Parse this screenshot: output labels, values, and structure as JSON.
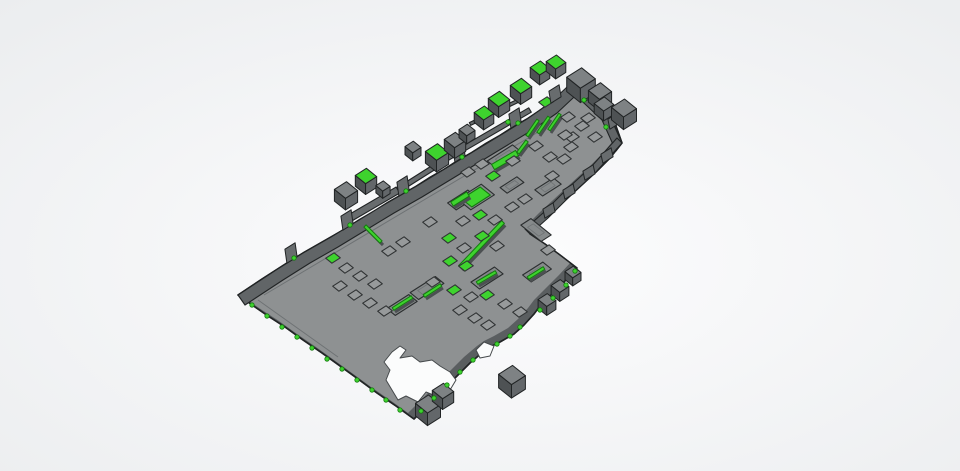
{
  "scene": {
    "canvas": {
      "width": 960,
      "height": 471
    },
    "colors": {
      "bg_center": "#fdfdfe",
      "bg_edge": "#eaecee",
      "plate": "#8e9192",
      "plate_wall": "#5a5e60",
      "outline": "#212425",
      "band": "#616567",
      "arm": "#686c6e",
      "trench_fill": "#868a8b",
      "trench_stroke": "#2b2e2f",
      "bump_fill": "#979a9b",
      "bump_stroke": "#303334",
      "green": "#3ed32e",
      "green_stroke": "#157a10",
      "strip_shadow": "#4c5052",
      "cube_top": "#7e8284",
      "cube_left": "#4e5254",
      "cube_right": "#63676a",
      "hole_fill": "#fbfcfc",
      "hole_stroke": "#45494b",
      "inner_line": "#6e7274"
    },
    "axes": {
      "u": [
        0.843,
        -0.538
      ],
      "v": [
        0.78,
        0.625
      ]
    },
    "plate_outline": [
      [
        573,
        80
      ],
      [
        583,
        89
      ],
      [
        591,
        96
      ],
      [
        600,
        104
      ],
      [
        608,
        112
      ],
      [
        616,
        126
      ],
      [
        622,
        143
      ],
      [
        610,
        158
      ],
      [
        596,
        172
      ],
      [
        585,
        182
      ],
      [
        572,
        194
      ],
      [
        558,
        207
      ],
      [
        545,
        219
      ],
      [
        530,
        234
      ],
      [
        545,
        244
      ],
      [
        560,
        255
      ],
      [
        577,
        268
      ],
      [
        565,
        281
      ],
      [
        552,
        294
      ],
      [
        540,
        306
      ],
      [
        534,
        314
      ],
      [
        524,
        325
      ],
      [
        514,
        334
      ],
      [
        500,
        342
      ],
      [
        490,
        347
      ],
      [
        483,
        352
      ],
      [
        470,
        363
      ],
      [
        458,
        375
      ],
      [
        446,
        387
      ],
      [
        434,
        399
      ],
      [
        424,
        409
      ],
      [
        414,
        419
      ],
      [
        396,
        406
      ],
      [
        377,
        393
      ],
      [
        358,
        379
      ],
      [
        340,
        366
      ],
      [
        322,
        353
      ],
      [
        303,
        340
      ],
      [
        285,
        327
      ],
      [
        268,
        316
      ],
      [
        255,
        307
      ],
      [
        238,
        295
      ],
      [
        250,
        287
      ],
      [
        262,
        279
      ],
      [
        276,
        270
      ],
      [
        290,
        261
      ],
      [
        303,
        253
      ],
      [
        317,
        245
      ],
      [
        331,
        237
      ],
      [
        345,
        229
      ],
      [
        359,
        220
      ],
      [
        373,
        212
      ],
      [
        387,
        203
      ],
      [
        401,
        195
      ],
      [
        415,
        187
      ],
      [
        429,
        178
      ],
      [
        443,
        170
      ],
      [
        457,
        161
      ],
      [
        471,
        153
      ],
      [
        485,
        144
      ],
      [
        499,
        136
      ],
      [
        513,
        127
      ],
      [
        527,
        119
      ],
      [
        539,
        111
      ],
      [
        550,
        103
      ],
      [
        560,
        96
      ],
      [
        567,
        88
      ]
    ],
    "inner_shift": [
      -6,
      -6
    ],
    "bands": [
      {
        "edge": [
          [
            238,
            295
          ],
          [
            276,
            270
          ],
          [
            303,
            253
          ],
          [
            331,
            237
          ],
          [
            359,
            220
          ],
          [
            387,
            203
          ],
          [
            415,
            187
          ],
          [
            443,
            170
          ],
          [
            471,
            153
          ],
          [
            499,
            136
          ],
          [
            527,
            119
          ],
          [
            550,
            103
          ],
          [
            566,
            88
          ],
          [
            573,
            80
          ]
        ],
        "off": [
          7,
          10
        ]
      },
      {
        "edge": [
          [
            573,
            80
          ],
          [
            591,
            96
          ],
          [
            608,
            112
          ],
          [
            622,
            143
          ]
        ],
        "off": [
          -6,
          8
        ]
      },
      {
        "edge": [
          [
            622,
            143
          ],
          [
            596,
            172
          ],
          [
            572,
            194
          ],
          [
            548,
            218
          ],
          [
            530,
            234
          ]
        ],
        "off": [
          -5,
          -5
        ]
      }
    ],
    "teeth": [
      {
        "x": 292,
        "y": 260,
        "h": 14
      },
      {
        "x": 348,
        "y": 227,
        "h": 14
      },
      {
        "x": 404,
        "y": 193,
        "h": 14
      },
      {
        "x": 460,
        "y": 159,
        "h": 14
      },
      {
        "x": 516,
        "y": 125,
        "h": 14
      },
      {
        "x": 556,
        "y": 100,
        "h": 12
      },
      {
        "x": 589,
        "y": 99,
        "h": 10
      },
      {
        "x": 603,
        "y": 112,
        "h": 10
      },
      {
        "x": 615,
        "y": 126,
        "h": 10
      },
      {
        "x": 608,
        "y": 160,
        "h": 9
      },
      {
        "x": 590,
        "y": 177,
        "h": 9
      },
      {
        "x": 570,
        "y": 196,
        "h": 9
      },
      {
        "x": 550,
        "y": 215,
        "h": 9
      }
    ],
    "arm_strips": [
      {
        "p": [
          350,
          218,
          398,
          190
        ],
        "w": 7
      },
      {
        "p": [
          398,
          190,
          436,
          166
        ],
        "w": 5
      },
      {
        "p": [
          444,
          160,
          530,
          110
        ],
        "w": 5
      },
      {
        "p": [
          470,
          124,
          528,
          96
        ],
        "w": 3
      }
    ],
    "inner_lines": [
      [
        264,
        295,
        545,
        128
      ],
      [
        258,
        300,
        338,
        357
      ]
    ],
    "trenches": [
      [
        505,
        157,
        30,
        13
      ],
      [
        462,
        200,
        24,
        11
      ],
      [
        427,
        288,
        30,
        11
      ],
      [
        402,
        305,
        26,
        11
      ],
      [
        487,
        278,
        28,
        11
      ],
      [
        537,
        272,
        24,
        11
      ],
      [
        512,
        185,
        20,
        9
      ],
      [
        548,
        187,
        22,
        10
      ],
      [
        536,
        230,
        12,
        26
      ],
      [
        476,
        197,
        28,
        17
      ]
    ],
    "pads": [
      [
        476,
        197,
        22,
        13
      ]
    ],
    "strips": [
      [
        503,
        222,
        460,
        267,
        4
      ],
      [
        538,
        120,
        527,
        136,
        3
      ],
      [
        549,
        117,
        538,
        133,
        3
      ],
      [
        560,
        114,
        549,
        130,
        3
      ],
      [
        527,
        141,
        518,
        153,
        3
      ],
      [
        365,
        226,
        381,
        242,
        3
      ],
      [
        493,
        167,
        517,
        153,
        6
      ],
      [
        452,
        204,
        468,
        194,
        5
      ],
      [
        393,
        309,
        412,
        297,
        3
      ],
      [
        424,
        296,
        441,
        285,
        3
      ],
      [
        477,
        283,
        496,
        272,
        3
      ],
      [
        528,
        278,
        544,
        268,
        3
      ]
    ],
    "bumps": [
      [
        468,
        172,
        0
      ],
      [
        482,
        164,
        0
      ],
      [
        493,
        176,
        1
      ],
      [
        513,
        161,
        0
      ],
      [
        536,
        146,
        0
      ],
      [
        550,
        157,
        0
      ],
      [
        572,
        137,
        0
      ],
      [
        546,
        102,
        1
      ],
      [
        568,
        117,
        0
      ],
      [
        582,
        126,
        0
      ],
      [
        565,
        135,
        0
      ],
      [
        571,
        147,
        0
      ],
      [
        564,
        159,
        0
      ],
      [
        588,
        118,
        0
      ],
      [
        595,
        137,
        0
      ],
      [
        449,
        238,
        1
      ],
      [
        464,
        248,
        0
      ],
      [
        482,
        236,
        1
      ],
      [
        497,
        246,
        0
      ],
      [
        450,
        261,
        1
      ],
      [
        466,
        266,
        1
      ],
      [
        433,
        282,
        0
      ],
      [
        454,
        290,
        1
      ],
      [
        471,
        297,
        0
      ],
      [
        487,
        295,
        1
      ],
      [
        505,
        304,
        0
      ],
      [
        520,
        312,
        0
      ],
      [
        333,
        258,
        1
      ],
      [
        346,
        268,
        0
      ],
      [
        360,
        276,
        0
      ],
      [
        375,
        284,
        0
      ],
      [
        340,
        286,
        0
      ],
      [
        355,
        295,
        0
      ],
      [
        370,
        303,
        0
      ],
      [
        385,
        311,
        0
      ],
      [
        475,
        318,
        0
      ],
      [
        488,
        325,
        0
      ],
      [
        460,
        310,
        0
      ],
      [
        525,
        199,
        0
      ],
      [
        512,
        207,
        0
      ],
      [
        552,
        176,
        0
      ],
      [
        495,
        220,
        0
      ],
      [
        548,
        250,
        0
      ],
      [
        430,
        222,
        0
      ],
      [
        480,
        215,
        1
      ],
      [
        463,
        221,
        0
      ],
      [
        403,
        242,
        0
      ],
      [
        389,
        251,
        0
      ]
    ],
    "cubes": [
      [
        346,
        190,
        13,
        0
      ],
      [
        366,
        176,
        12,
        1
      ],
      [
        383,
        186,
        8,
        0
      ],
      [
        413,
        147,
        9,
        0
      ],
      [
        437,
        152,
        13,
        1
      ],
      [
        455,
        140,
        12,
        0
      ],
      [
        467,
        130,
        9,
        0
      ],
      [
        484,
        113,
        11,
        1
      ],
      [
        499,
        99,
        12,
        1
      ],
      [
        521,
        86,
        12,
        1
      ],
      [
        540,
        68,
        11,
        1
      ],
      [
        556,
        62,
        11,
        1
      ],
      [
        581,
        78,
        16,
        0
      ],
      [
        600,
        91,
        13,
        0
      ],
      [
        604,
        104,
        11,
        0
      ],
      [
        624,
        108,
        14,
        0
      ],
      [
        512,
        375,
        15,
        0
      ],
      [
        428,
        404,
        14,
        0
      ],
      [
        443,
        391,
        12,
        0
      ],
      [
        573,
        272,
        9,
        0
      ],
      [
        560,
        286,
        10,
        0
      ],
      [
        547,
        300,
        10,
        0
      ]
    ],
    "studs": [
      [
        252,
        305
      ],
      [
        267,
        316
      ],
      [
        282,
        327
      ],
      [
        297,
        337
      ],
      [
        312,
        348
      ],
      [
        327,
        359
      ],
      [
        342,
        369
      ],
      [
        357,
        380
      ],
      [
        372,
        390
      ],
      [
        386,
        400
      ],
      [
        400,
        410
      ],
      [
        421,
        411
      ],
      [
        434,
        398
      ],
      [
        447,
        385
      ],
      [
        460,
        372
      ],
      [
        473,
        360
      ],
      [
        497,
        344
      ],
      [
        510,
        336
      ],
      [
        520,
        327
      ],
      [
        540,
        310
      ],
      [
        553,
        298
      ],
      [
        566,
        285
      ],
      [
        575,
        271
      ],
      [
        584,
        100
      ],
      [
        606,
        127
      ],
      [
        508,
        122
      ],
      [
        294,
        258
      ],
      [
        350,
        225
      ],
      [
        406,
        191
      ],
      [
        462,
        157
      ],
      [
        518,
        123
      ]
    ],
    "holes": [
      [
        [
          392,
          352
        ],
        [
          400,
          346
        ],
        [
          406,
          350
        ],
        [
          400,
          358
        ],
        [
          412,
          356
        ],
        [
          420,
          362
        ],
        [
          432,
          360
        ],
        [
          440,
          366
        ],
        [
          450,
          372
        ],
        [
          456,
          380
        ],
        [
          450,
          390
        ],
        [
          442,
          386
        ],
        [
          436,
          396
        ],
        [
          426,
          392
        ],
        [
          418,
          402
        ],
        [
          406,
          396
        ],
        [
          398,
          400
        ],
        [
          392,
          390
        ],
        [
          386,
          380
        ],
        [
          390,
          370
        ],
        [
          384,
          362
        ]
      ],
      [
        [
          476,
          350
        ],
        [
          484,
          342
        ],
        [
          494,
          346
        ],
        [
          490,
          356
        ],
        [
          480,
          358
        ]
      ]
    ]
  }
}
